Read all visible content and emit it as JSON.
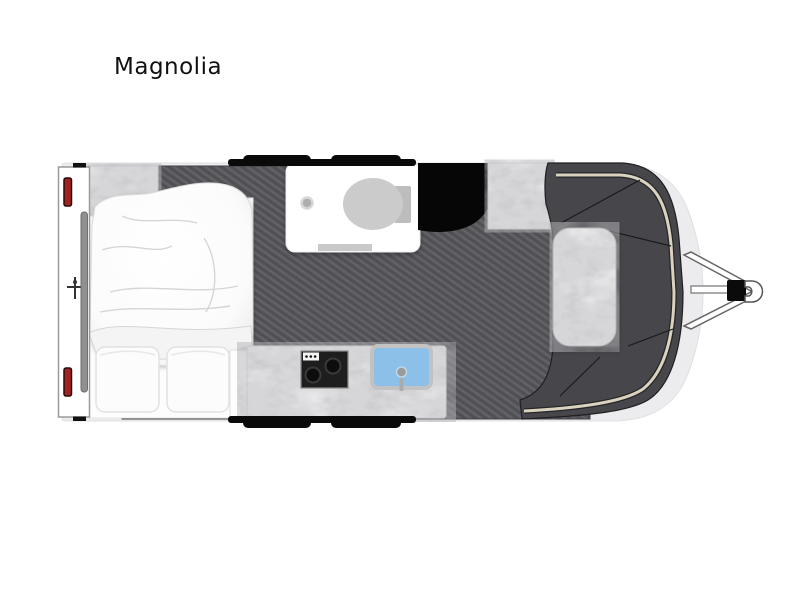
{
  "page": {
    "title": "Magnolia",
    "background": "#ffffff"
  },
  "floorplan": {
    "type": "travel-trailer-floorplan",
    "rooms": [
      "rear-bedroom",
      "bathroom",
      "kitchen",
      "front-lounge"
    ],
    "features": [
      {
        "name": "bed",
        "label": "island bed with duvet and two pillows"
      },
      {
        "name": "bathroom",
        "label": "toilet room with drain and mat"
      },
      {
        "name": "appliance-cabinet",
        "label": "black cabinet beside bathroom"
      },
      {
        "name": "kitchen-bench",
        "label": "cooktop and sink on stone bench"
      },
      {
        "name": "front-lounge",
        "label": "curved lounge with piping trim and stone table"
      },
      {
        "name": "drawbar-hitch",
        "label": "a-frame drawbar with jack and coupler"
      },
      {
        "name": "wheels",
        "label": "tandem wheels on both sides"
      },
      {
        "name": "tail-lights",
        "label": "red rear light bars"
      }
    ],
    "colors": {
      "floor": "#56565a",
      "lounge": "#47474b",
      "piping": "#d9d2be",
      "sink": "#8cc0e8",
      "tail_light": "#a12222",
      "appliance": "#060606",
      "body_shell": "#ececee",
      "stone": "#f7f7f7"
    }
  }
}
